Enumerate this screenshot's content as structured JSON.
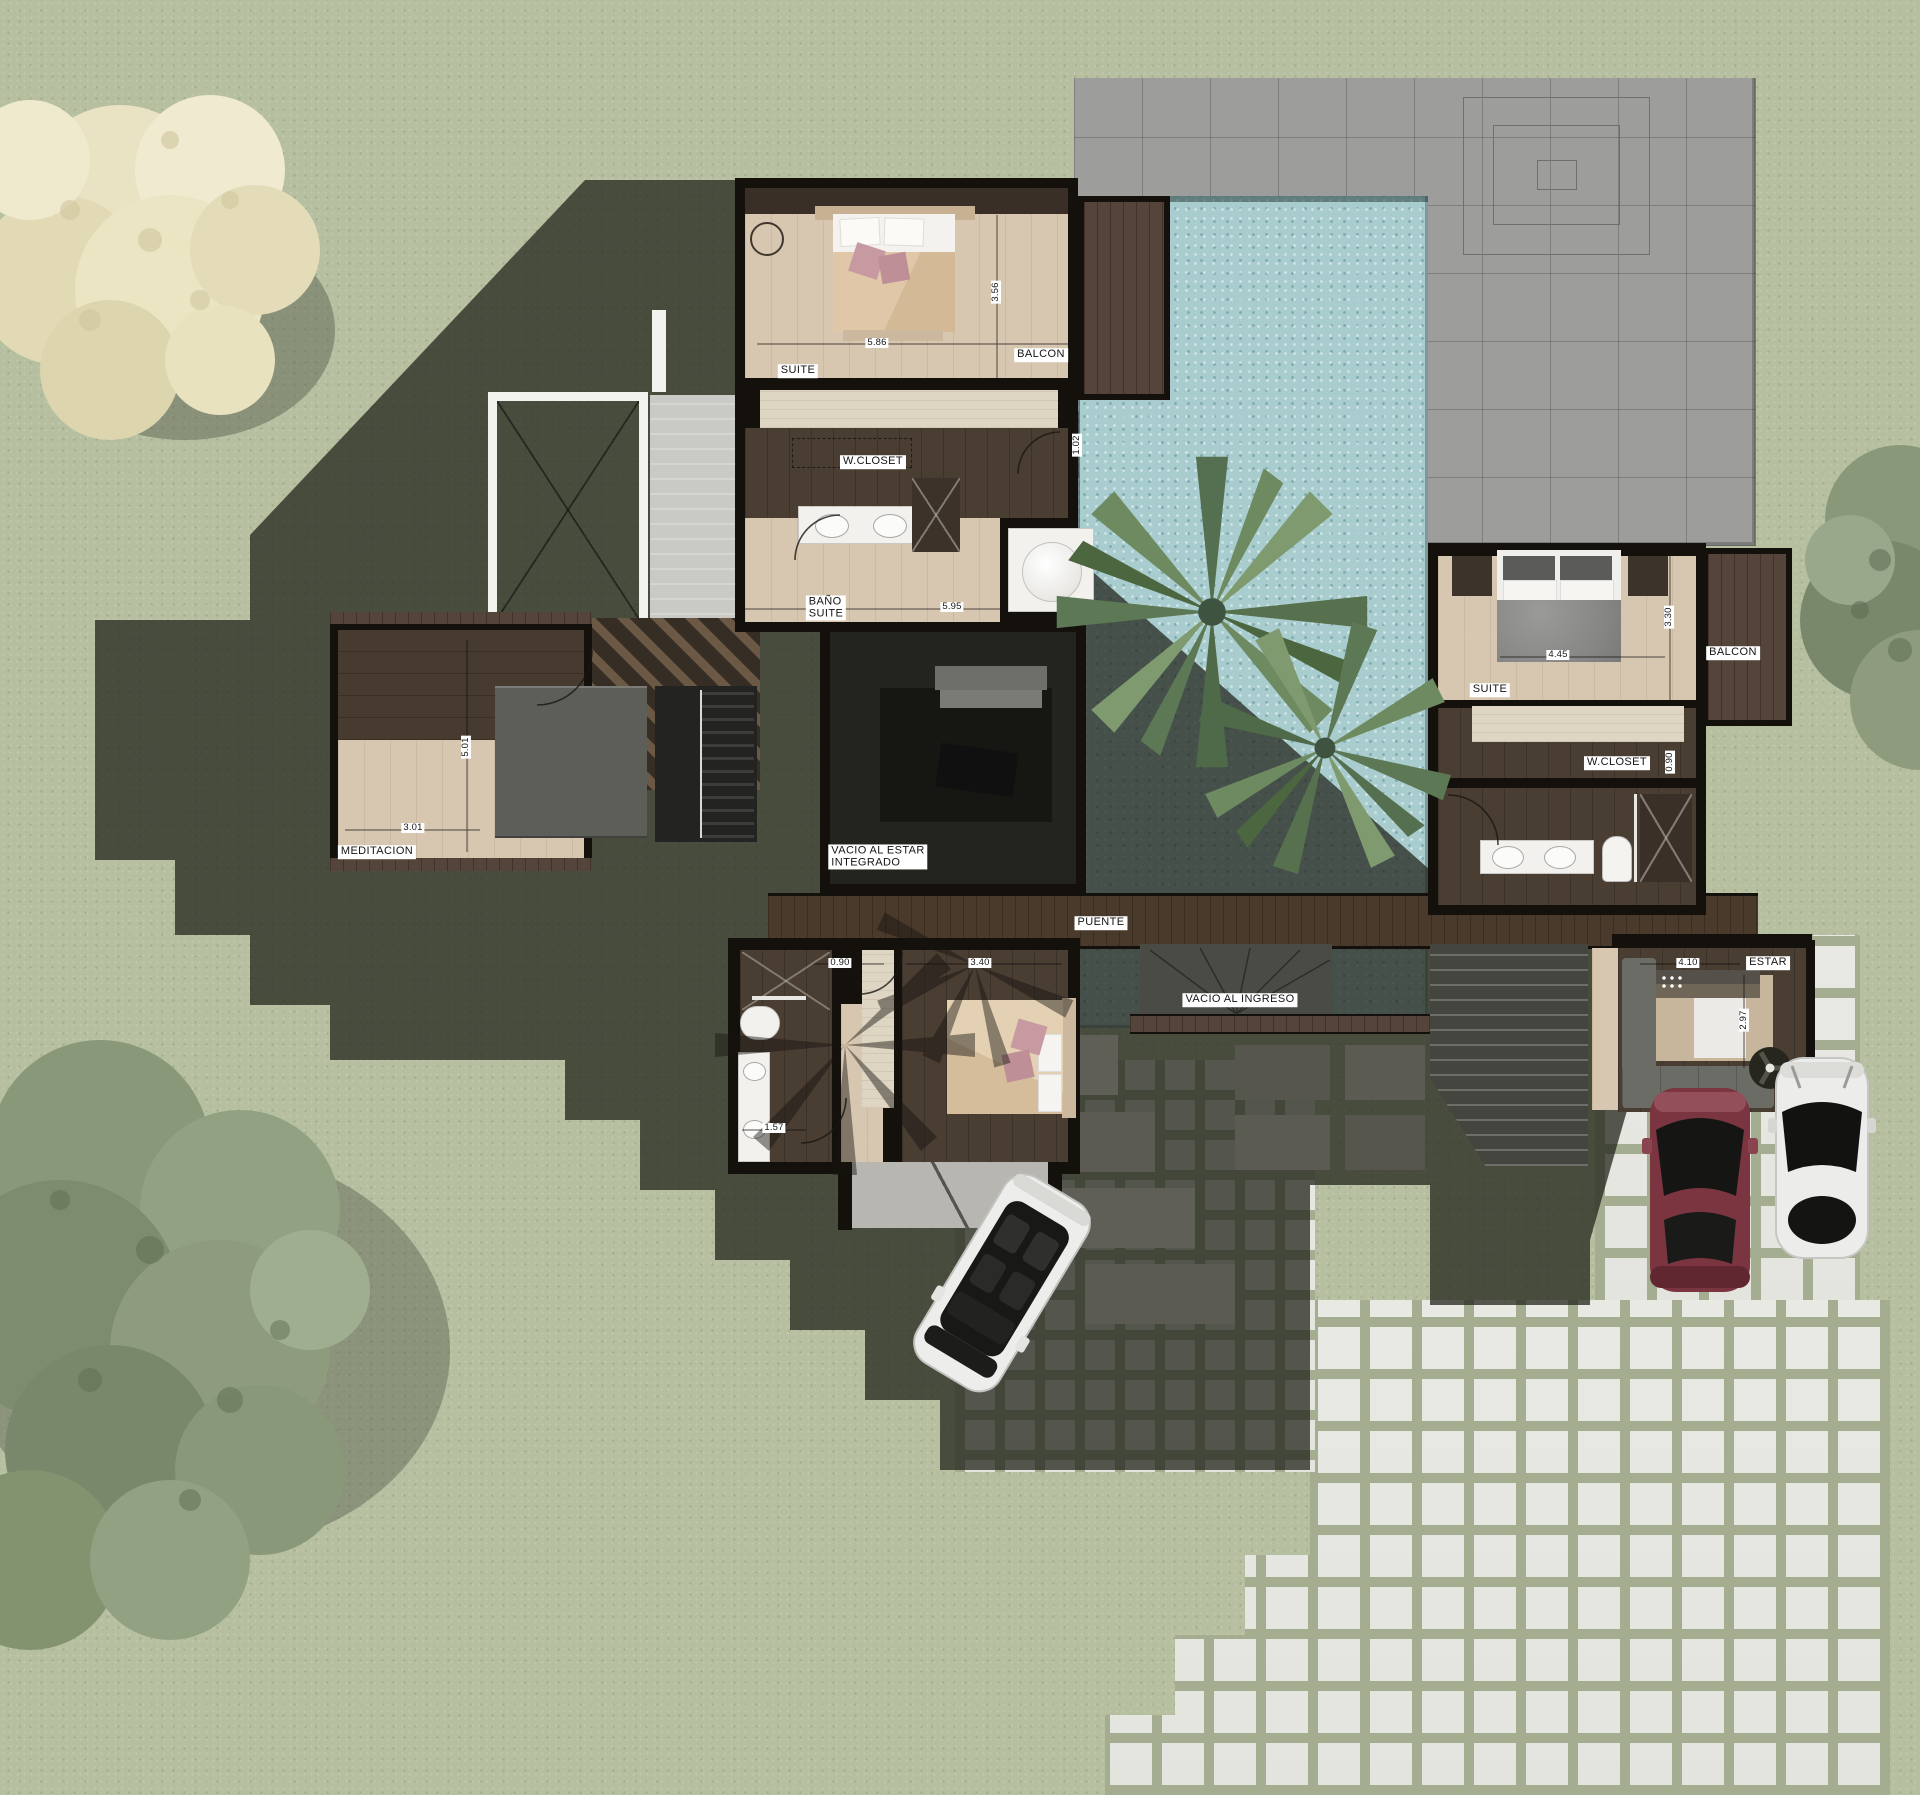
{
  "scene": {
    "type": "architectural-site-plan-render",
    "description": "Top-view rendered floor plan of a modern two-volume house with pool, terrace, garden, parked cars and paver patios"
  },
  "colors": {
    "grass": "#b6bfa0",
    "shadow": "#23251c",
    "pool_water": "#a9cdcf",
    "terrace_stone": "#9d9e9b",
    "wood_light": "#d8c7b0",
    "wood_dark": "#4a3e33",
    "wall": "#14110d",
    "paver_white": "#e9e9e4",
    "cushion_pink": "#c79aa2",
    "car_red": "#7b3540",
    "car_white": "#ededeb",
    "palm_green": "#5d7457",
    "tree_cream": "#e9e3c4",
    "tree_green": "#8a987a"
  },
  "plan": {
    "labels": [
      {
        "id": "suite1-label",
        "text": "SUITE",
        "x": 798,
        "y": 371,
        "rot": 0,
        "kind": "room"
      },
      {
        "id": "suite1-width",
        "text": "5.86",
        "x": 877,
        "y": 343,
        "rot": 0,
        "kind": "dim"
      },
      {
        "id": "suite1-depth",
        "text": "3.56",
        "x": 996,
        "y": 292,
        "rot": 90,
        "kind": "dim"
      },
      {
        "id": "balcon1-label",
        "text": "BALCON",
        "x": 1041,
        "y": 355,
        "rot": 0,
        "kind": "room"
      },
      {
        "id": "wcloset1-label",
        "text": "W.CLOSET",
        "x": 873,
        "y": 462,
        "rot": 0,
        "kind": "room"
      },
      {
        "id": "wcloset1-depth",
        "text": "1.02",
        "x": 1077,
        "y": 445,
        "rot": 90,
        "kind": "dim"
      },
      {
        "id": "bano-suite-label",
        "text": "BAÑO\nSUITE",
        "x": 826,
        "y": 608,
        "rot": 0,
        "kind": "room"
      },
      {
        "id": "bano-suite-width",
        "text": "5.95",
        "x": 952,
        "y": 607,
        "rot": 0,
        "kind": "dim"
      },
      {
        "id": "meditacion-width",
        "text": "3.01",
        "x": 413,
        "y": 828,
        "rot": 0,
        "kind": "dim"
      },
      {
        "id": "meditacion-label",
        "text": "MEDITACION",
        "x": 377,
        "y": 852,
        "rot": 0,
        "kind": "room"
      },
      {
        "id": "meditacion-depth",
        "text": "5.01",
        "x": 466,
        "y": 747,
        "rot": 90,
        "kind": "dim"
      },
      {
        "id": "vacio-estar-label",
        "text": "VACIO AL ESTAR\nINTEGRADO",
        "x": 878,
        "y": 857,
        "rot": 0,
        "kind": "room"
      },
      {
        "id": "puente-label",
        "text": "PUENTE",
        "x": 1101,
        "y": 923,
        "rot": 0,
        "kind": "room"
      },
      {
        "id": "suite2-label",
        "text": "SUITE",
        "x": 1490,
        "y": 690,
        "rot": 0,
        "kind": "room"
      },
      {
        "id": "suite2-width",
        "text": "4.45",
        "x": 1558,
        "y": 655,
        "rot": 0,
        "kind": "dim"
      },
      {
        "id": "suite2-depth",
        "text": "3.30",
        "x": 1669,
        "y": 617,
        "rot": 90,
        "kind": "dim"
      },
      {
        "id": "balcon2-label",
        "text": "BALCON",
        "x": 1733,
        "y": 653,
        "rot": 0,
        "kind": "room"
      },
      {
        "id": "wcloset2-label",
        "text": "W.CLOSET",
        "x": 1617,
        "y": 763,
        "rot": 0,
        "kind": "room"
      },
      {
        "id": "wcloset2-depth",
        "text": "0.90",
        "x": 1670,
        "y": 762,
        "rot": 90,
        "kind": "dim"
      },
      {
        "id": "vacio-ingreso-label",
        "text": "VACIO AL INGRESO",
        "x": 1240,
        "y": 1000,
        "rot": 0,
        "kind": "room"
      },
      {
        "id": "estar-width",
        "text": "4.10",
        "x": 1688,
        "y": 963,
        "rot": 0,
        "kind": "dim"
      },
      {
        "id": "estar-label",
        "text": "ESTAR",
        "x": 1768,
        "y": 963,
        "rot": 0,
        "kind": "room"
      },
      {
        "id": "estar-depth",
        "text": "2.97",
        "x": 1744,
        "y": 1020,
        "rot": 90,
        "kind": "dim"
      },
      {
        "id": "closet3-width",
        "text": "0.90",
        "x": 840,
        "y": 963,
        "rot": 0,
        "kind": "dim"
      },
      {
        "id": "bedroom3-width",
        "text": "3.40",
        "x": 980,
        "y": 963,
        "rot": 0,
        "kind": "dim"
      },
      {
        "id": "bano3-width",
        "text": "1.57",
        "x": 774,
        "y": 1128,
        "rot": 0,
        "kind": "dim"
      }
    ]
  }
}
